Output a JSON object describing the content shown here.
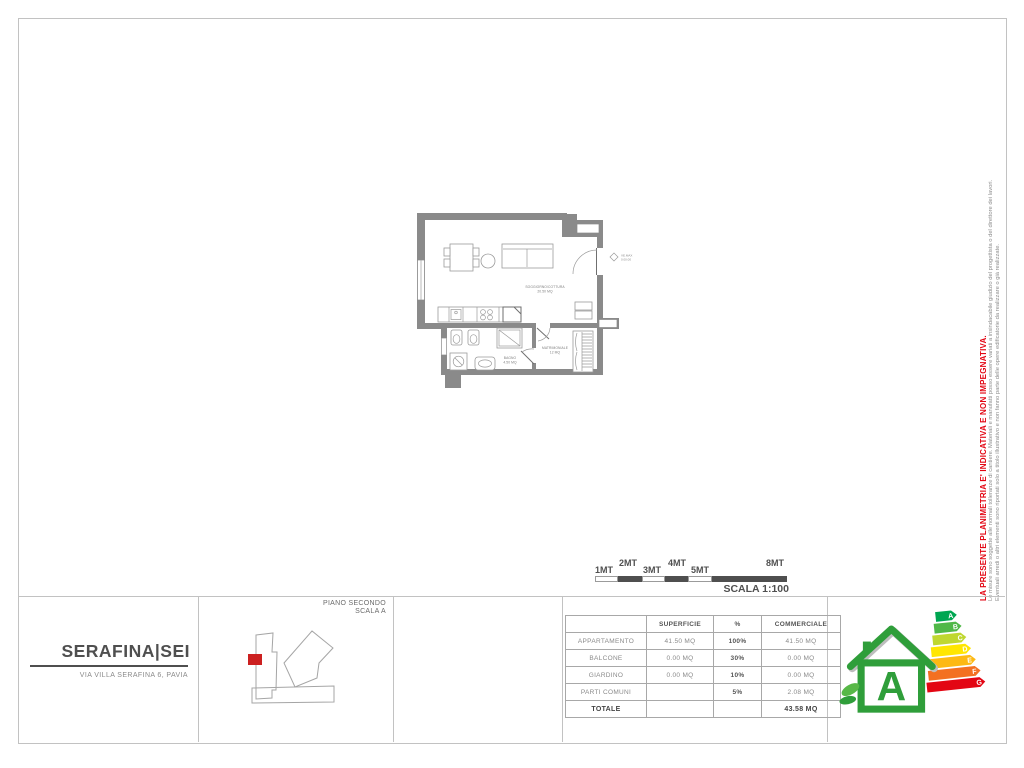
{
  "disclaimer": {
    "headline": "LA PRESENTE PLANIMETRIA E' INDICATIVA E NON IMPEGNATIVA.",
    "note1": "Le misure sono soggette alle normali tolleranze di cantiere. Materiali e manufatti posso essere variati a insindacabile giudizio del progettista o del direttore dei lavori.",
    "note2": "Eventuali arredi o altri elementi sono riportati solo a titolo illustrativo e non fanno parte delle opere edificatorie da realizzare o già realizzate."
  },
  "scalebar": {
    "labels": [
      "1MT",
      "2MT",
      "3MT",
      "4MT",
      "5MT",
      "8MT"
    ],
    "caption": "SCALA 1:100"
  },
  "floorplan": {
    "living": {
      "name": "SOGGIORNO/COTTURA",
      "area": "20.50 MQ"
    },
    "bedroom": {
      "name": "MATRIMONIALE",
      "area": "12 MQ"
    },
    "bathroom": {
      "name": "BAGNO",
      "area": "4.50 MQ"
    },
    "marker": {
      "line1": "VE.MAX",
      "line2": "0.00.00"
    }
  },
  "title_block": {
    "project": "SERAFINA|SEI",
    "address": "VIA VILLA SERAFINA 6, PAVIA"
  },
  "keyplan": {
    "floor": "PIANO SECONDO",
    "staircase": "SCALA A",
    "marker_color": "#cc2020"
  },
  "surface_table": {
    "headers": [
      "",
      "SUPERFICIE",
      "%",
      "COMMERCIALE"
    ],
    "rows": [
      {
        "label": "APPARTAMENTO",
        "superficie": "41.50 MQ",
        "percent": "100%",
        "commerciale": "41.50 MQ"
      },
      {
        "label": "BALCONE",
        "superficie": "0.00 MQ",
        "percent": "30%",
        "commerciale": "0.00 MQ"
      },
      {
        "label": "GIARDINO",
        "superficie": "0.00 MQ",
        "percent": "10%",
        "commerciale": "0.00 MQ"
      },
      {
        "label": "PARTI COMUNI",
        "superficie": "",
        "percent": "5%",
        "commerciale": "2.08 MQ"
      },
      {
        "label": "TOTALE",
        "superficie": "",
        "percent": "",
        "commerciale": "43.58 MQ"
      }
    ]
  },
  "energy_label": {
    "rating": "A",
    "bars": [
      {
        "letter": "A",
        "color": "#00a651"
      },
      {
        "letter": "B",
        "color": "#50b848"
      },
      {
        "letter": "C",
        "color": "#bfd730"
      },
      {
        "letter": "D",
        "color": "#ffe600"
      },
      {
        "letter": "E",
        "color": "#fdb913"
      },
      {
        "letter": "F",
        "color": "#f37021"
      },
      {
        "letter": "G",
        "color": "#e30613"
      }
    ]
  }
}
